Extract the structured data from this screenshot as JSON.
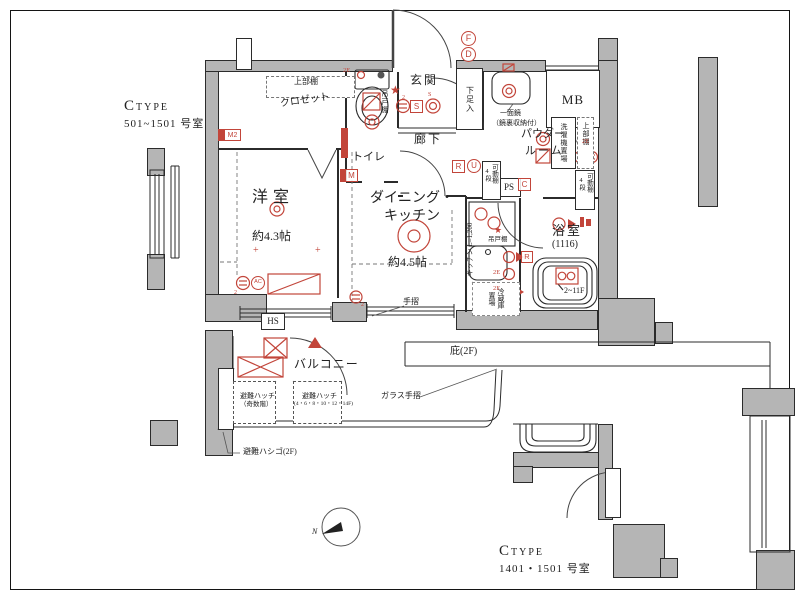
{
  "colors": {
    "red": "#c2453a",
    "wall": "#b5b5b5",
    "line": "#2b2b2b"
  },
  "titles": {
    "top": {
      "c": "C",
      "type": "TYPE",
      "unit": "501~1501 号室"
    },
    "bottom": {
      "c": "C",
      "type": "TYPE",
      "unit": "1401・1501 号室"
    }
  },
  "rooms": {
    "living": "洋室",
    "living_size": "約4.3帖",
    "dk1": "ダイニング・",
    "dk2": "キッチン",
    "dk_size": "約4.5帖",
    "entrance": "玄関",
    "hall": "廊下",
    "toilet": "トイレ",
    "powder1": "パウダー",
    "powder2": "ルーム",
    "bath": "浴室",
    "bath_size": "(1116)",
    "bath_floors": "2~11F",
    "balcony": "バルコニー",
    "mb": "MB",
    "ps": "PS",
    "hs": "HS"
  },
  "labels": {
    "upper_shelf": "上部棚",
    "closet": "クロゼット",
    "shoe": "下足入",
    "mirror1": "一面鏡",
    "mirror2": "（鏡裏収納付）",
    "washer": "洗濯機置場",
    "movable": "可動棚",
    "movable_steps": "4段",
    "kitchen_len": "キッチン L=1,200",
    "hanging": "吊戸棚",
    "fridge1": "冷蔵庫",
    "fridge2": "置場",
    "handrail": "手摺",
    "glass_handrail": "ガラス手摺",
    "eaves": "庇(2F)",
    "hatch": "避難ハッチ",
    "hatch_odd": "（奇数階）",
    "hatch_even": "(4・6・8・10・12・14F)",
    "ladder": "避難ハシゴ(2F)"
  },
  "badges": {
    "f": "F",
    "d": "D",
    "s": "S",
    "s_small": "S",
    "m2": "M2",
    "m": "M",
    "r": "R",
    "u": "U",
    "c": "C",
    "e2": "2E",
    "ac": "AC",
    "star": "★",
    "sub2": "2",
    "plus": "+"
  },
  "compass": {
    "n": "N"
  }
}
